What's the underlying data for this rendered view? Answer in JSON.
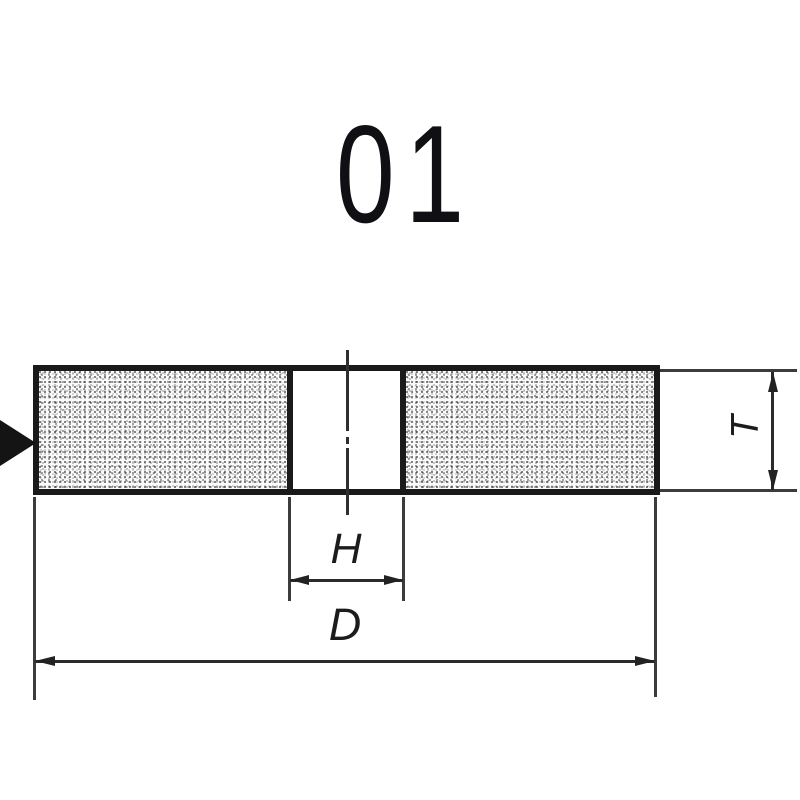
{
  "figure": {
    "title": "01",
    "labels": {
      "thickness": "T",
      "bore": "H",
      "diameter": "D"
    },
    "colors": {
      "background": "#ffffff",
      "outline": "#1a1a1a",
      "dimension_line": "#2b2b2b",
      "extension_line": "#3c3c3c",
      "grain_fill": "#fbfbfb",
      "grain_dot": "#3f3f3f"
    }
  }
}
